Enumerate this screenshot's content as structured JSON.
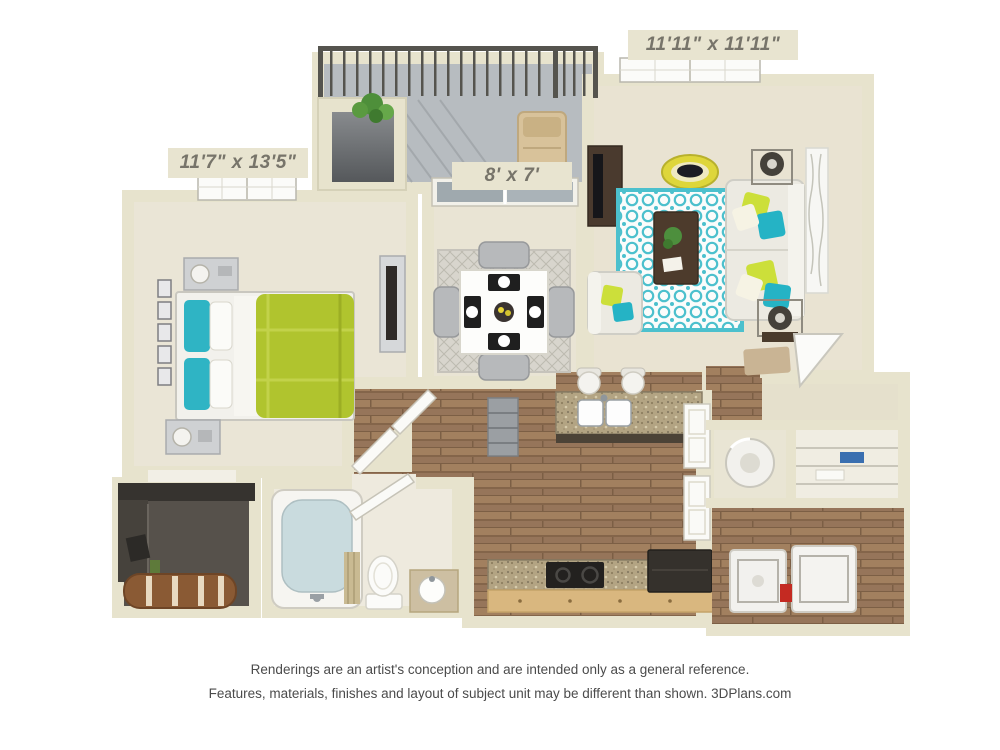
{
  "labels": {
    "bedroom": "11'7\" x 13'5\"",
    "patio": "8' x 7'",
    "living_room": "11'11\" x 11'11\""
  },
  "disclaimer": {
    "line1": "Renderings are an artist's conception and are intended only as a general reference.",
    "line2": "Features, materials, finishes and layout of subject unit may be different than shown. 3DPlans.com"
  },
  "colors": {
    "wall": "#e7e3cd",
    "carpet": "#eae5d6",
    "wood_floor": "#9b7b5d",
    "balcony_floor": "#b7bcc0",
    "granite_counter": "#b3a483",
    "accent_green": "#b0c42e",
    "accent_teal": "#2fb4c4",
    "rug_teal": "#4cc0cd",
    "label_text": "#77746a",
    "disclaimer_text": "#4b4b4b"
  }
}
